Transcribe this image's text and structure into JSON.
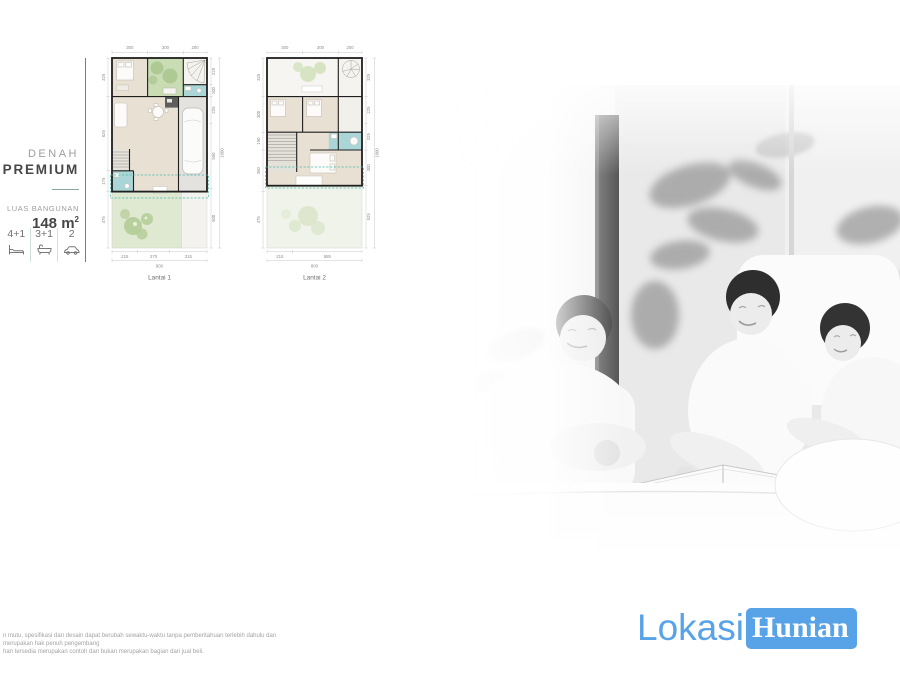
{
  "panel": {
    "denah_label": "DENAH",
    "plan_name": "PREMIUM",
    "luas_label": "LUAS BANGUNAN",
    "area_value": "148",
    "area_unit_base": "m",
    "area_unit_sup": "2",
    "accent_color": "#3e9b72",
    "specs": [
      {
        "value": "4+1",
        "icon": "bed-icon"
      },
      {
        "value": "3+1",
        "icon": "bath-icon"
      },
      {
        "value": "2",
        "icon": "car-icon"
      }
    ]
  },
  "floorplans": [
    {
      "label": "Lantai 1",
      "dims_top": [
        "300",
        "300",
        "200"
      ],
      "dims_left": [
        "325",
        "625",
        "175",
        "475"
      ],
      "dims_right": [
        "225",
        "100",
        "225",
        "550",
        "500"
      ],
      "dims_right_total": "1600",
      "dims_bottom": [
        "215",
        "270",
        "315"
      ],
      "dims_bottom_total": "800"
    },
    {
      "label": "Lantai 2",
      "dims_top": [
        "300",
        "300",
        "200"
      ],
      "dims_left": [
        "325",
        "300",
        "150",
        "350",
        "475"
      ],
      "dims_right": [
        "325",
        "225",
        "225",
        "300",
        "525"
      ],
      "dims_right_total": "1600",
      "dims_bottom": [
        "215",
        "585"
      ],
      "dims_bottom_total": "800"
    }
  ],
  "photo": {
    "name": "family-reading-photo"
  },
  "footer": {
    "line1": "n mutu, spesifikasi dan desain dapat berubah sewaktu-waktu tanpa pemberitahuan terlebih dahulu dan merupakan hak penuh pengembang",
    "line2": "han tersedia merupakan contoh dan bukan merupakan bagian dari jual beli."
  },
  "logo": {
    "part1": "Lokasi",
    "part2": "Hunian",
    "brand_color": "#58a3e7"
  },
  "colors": {
    "plan_floor": "#e8e0d3",
    "plan_garden": "#c9dcb4",
    "plan_bath": "#abd6d8",
    "plan_wall": "#1f1f1f",
    "dash_teal": "#49b9a9"
  }
}
